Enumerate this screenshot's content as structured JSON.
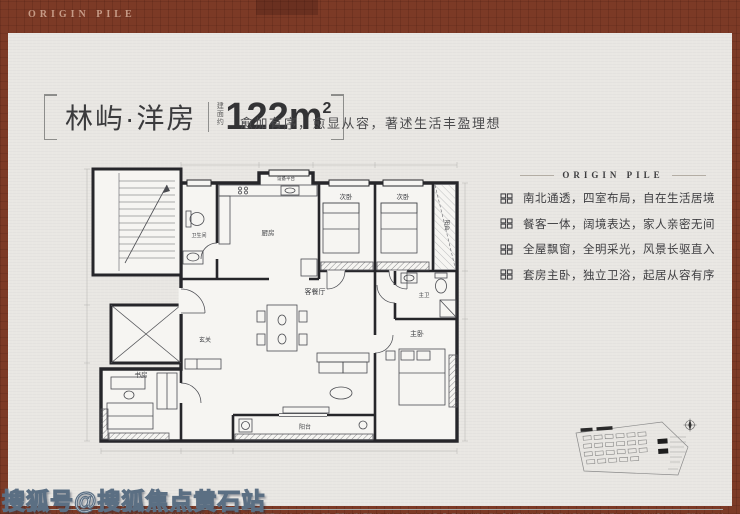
{
  "brand": {
    "logo_text": "ORIGIN PILE"
  },
  "header": {
    "title": "林屿·洋房",
    "area_label": "建面约",
    "area_value": "122m",
    "area_sup": "2",
    "tagline": "愈加有序，愈显从容，著述生活丰盈理想"
  },
  "features": {
    "heading": "ORIGIN PILE",
    "items": [
      "南北通透，四室布局，自在生活居境",
      "餐客一体，阔境表达，家人亲密无间",
      "全屋飘窗，全明采光，风景长驱直入",
      "套房主卧，独立卫浴，起居从容有序"
    ]
  },
  "floorplan": {
    "labels": {
      "equipment": "设备平台",
      "kitchen": "厨房",
      "bath": "卫生间",
      "bedroom_a": "次卧",
      "bedroom_b": "次卧",
      "balcony_top": "阳台",
      "master_bath": "主卫",
      "master": "主卧",
      "living": "客餐厅",
      "foyer": "玄关",
      "study": "书房",
      "balcony_bottom": "阳台"
    },
    "watermark": "程橙"
  },
  "footer": {
    "disclaimer": "免责声明：本宣传资料为要约邀请，不构成要约或承诺，相关内容不排除因政府规划、规定及开发商未能控制的原因而发生变化；户型图为示意图，面积均为建筑面积约值，装修、家具、家电仅作展示用，不代表交付标准，最终以政府部门核准文件及商品房买卖合同约定为准；周边配套、交通、教育等信息仅供参考；（图册广告）（海上原聚），批号详见售楼处公示【2023】第111号，制作时间2023年11月，有效期30天，敬请留意最新资料。",
    "watermark": "搜狐号@搜狐焦点黄石站"
  }
}
